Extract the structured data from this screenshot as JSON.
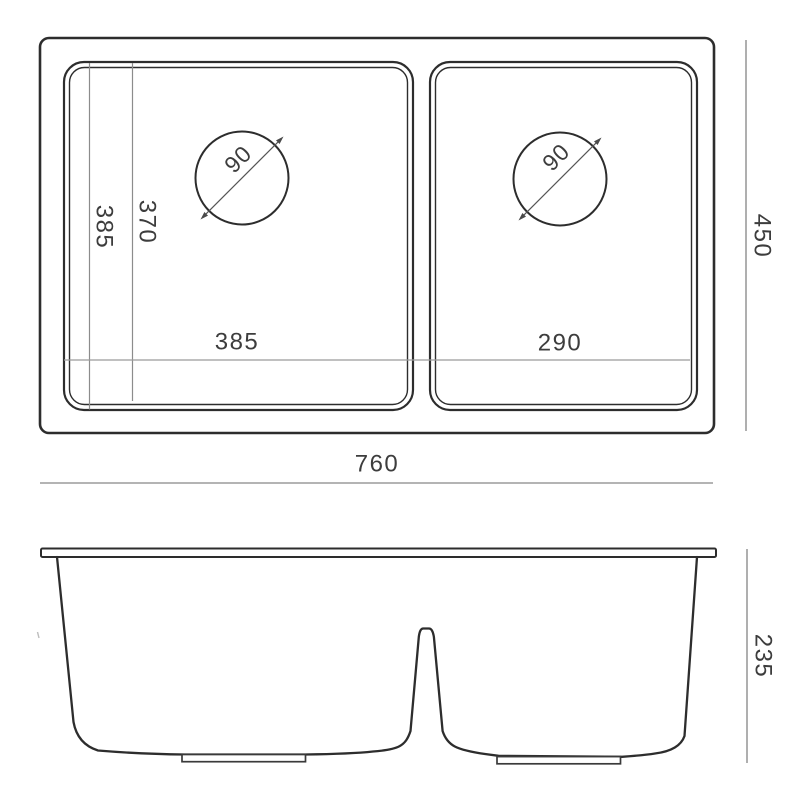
{
  "views": {
    "top": {
      "overall_width": "760",
      "overall_depth": "450",
      "left_bowl_width": "385",
      "right_bowl_width": "290",
      "bowl_depth_outer": "385",
      "bowl_depth_inner": "370",
      "left_drain_diameter": "90",
      "right_drain_diameter": "90"
    },
    "front": {
      "bowl_height": "235"
    }
  },
  "colors": {
    "line": "#2d2d2d",
    "dim_line": "#9b9b9b",
    "text": "#3d3d3d",
    "background": "#ffffff"
  }
}
